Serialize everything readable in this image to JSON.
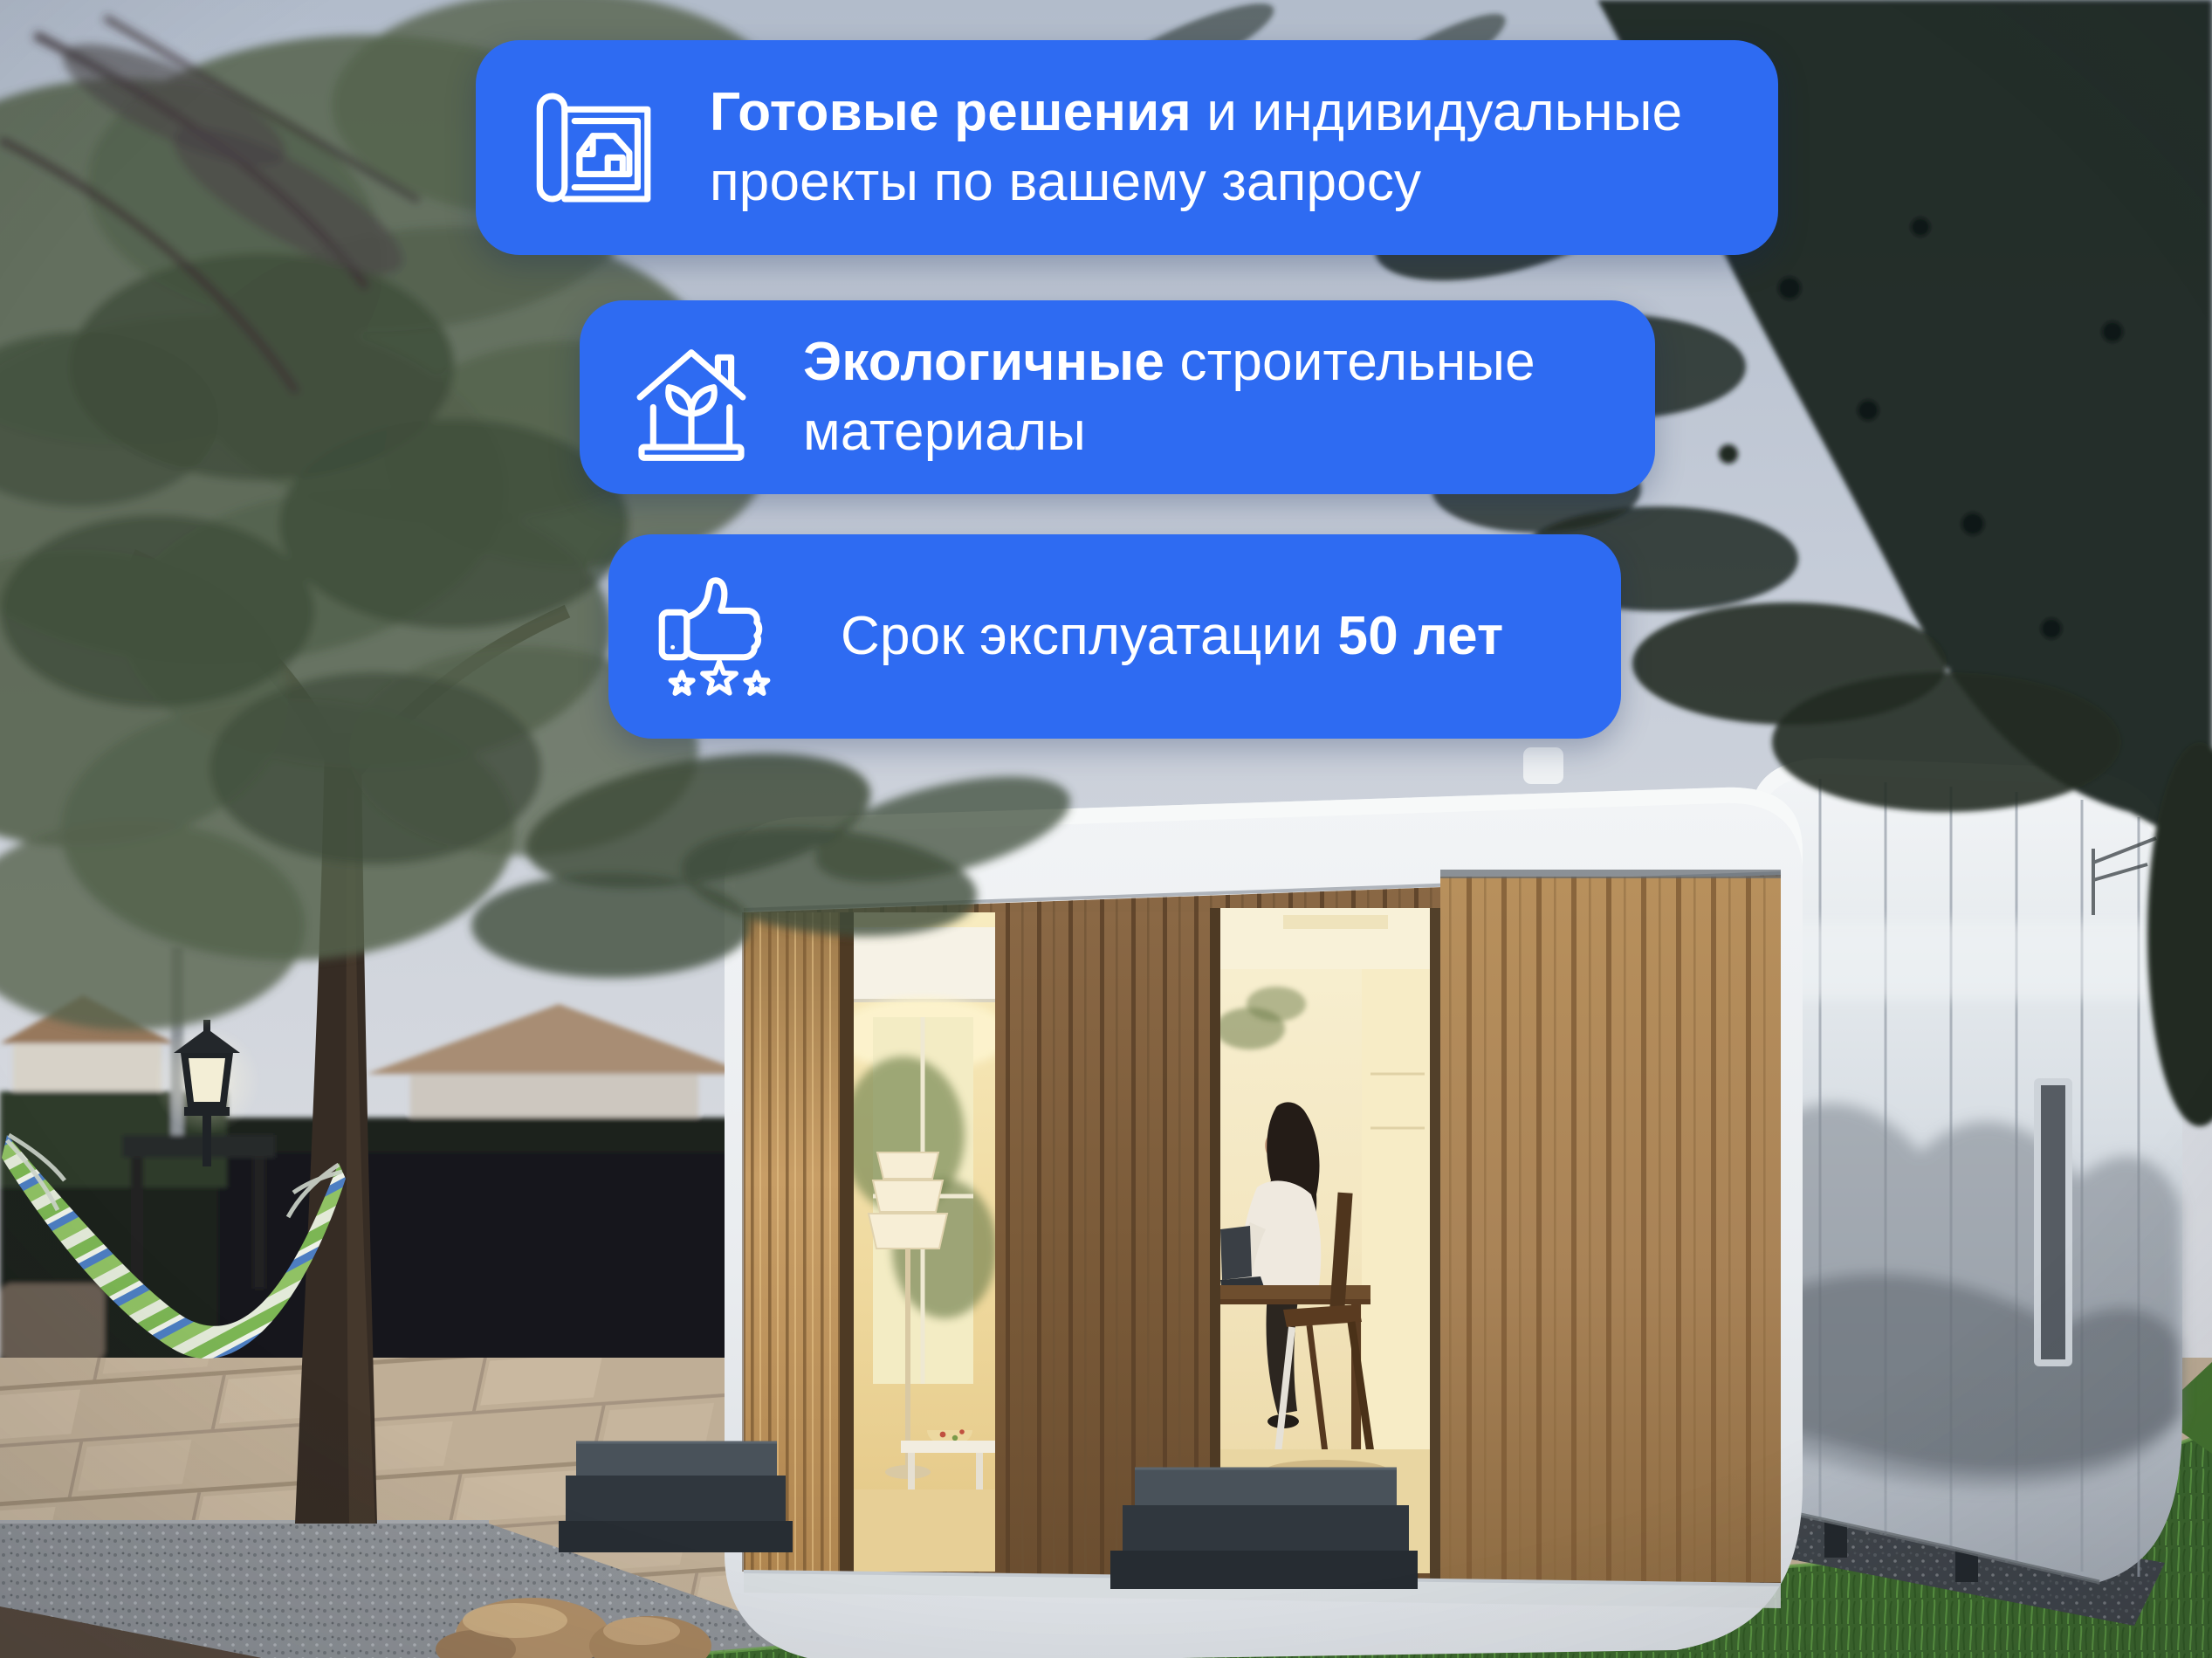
{
  "colors": {
    "badge_background": "#2e6bf2",
    "badge_text": "#ffffff"
  },
  "badges": [
    {
      "id": "ready-solutions",
      "icon": "blueprint-house-icon",
      "line1_bold": "Готовые решения",
      "line1_regular": " и индивидуальные",
      "line2": "проекты по вашему запросу"
    },
    {
      "id": "eco-materials",
      "icon": "eco-house-icon",
      "line1_bold": "Экологичные",
      "line1_regular": " строительные",
      "line2": "материалы"
    },
    {
      "id": "lifespan",
      "icon": "thumbs-up-stars-icon",
      "line_regular": "Срок эксплуатации ",
      "line_bold": "50 лет"
    }
  ]
}
